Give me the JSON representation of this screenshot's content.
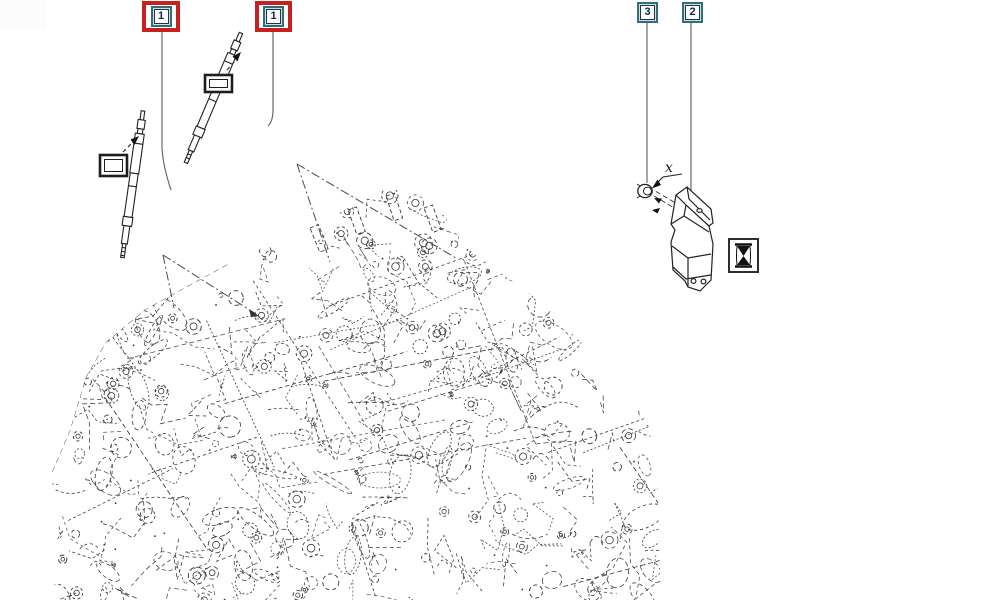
{
  "diagram": {
    "kind": "engine parts diagram",
    "callouts": [
      {
        "id": "1a",
        "label": "1",
        "highlighted": true
      },
      {
        "id": "1b",
        "label": "1",
        "highlighted": true
      },
      {
        "id": "3",
        "label": "3",
        "highlighted": false
      },
      {
        "id": "2",
        "label": "2",
        "highlighted": false
      }
    ],
    "annotations": {
      "dimension_label": "x"
    },
    "icons": {
      "note_icon": "hourglass-icon"
    },
    "colors": {
      "background": "#ffffff",
      "highlight_red": "#c5211f",
      "callout_border_teal": "#2d7079",
      "callout_fill": "#d2e0e3",
      "drawing_line": "#3d3d3d",
      "leader_line": "#666666"
    }
  }
}
